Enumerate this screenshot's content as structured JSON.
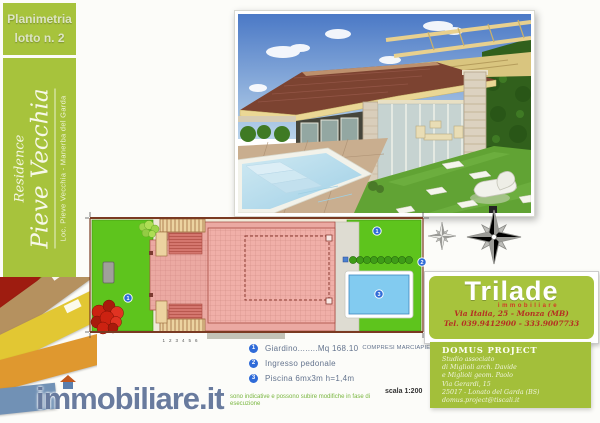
{
  "plan_label": {
    "line1": "Planimetria",
    "line2": "lotto n. 2"
  },
  "sidebar": {
    "prefix": "Residence",
    "name": "Pieve Vecchia",
    "location": "Loc. Pieve Vecchia - Manerba del Garda"
  },
  "plan": {
    "step_numbers": "123456",
    "markers": {
      "garden": "1",
      "entrance": "2",
      "pool": "3"
    }
  },
  "legend": {
    "items": [
      {
        "num": "1",
        "text": "Giardino........Mq 168.10",
        "note": "COMPRESI MARCIAPIEDI"
      },
      {
        "num": "2",
        "text": "Ingresso pedonale",
        "note": ""
      },
      {
        "num": "3",
        "text": "Piscina 6mx3m  h=1,4m",
        "note": ""
      }
    ]
  },
  "scale_label": "scala 1:200",
  "agency": {
    "name": "Trilade",
    "tagline": "immobiliare",
    "address": "Via Italia, 25 - Monza (MB)",
    "phone": "Tel. 039.9412900 - 333.9007733"
  },
  "studio": {
    "title": "DOMUS PROJECT",
    "line1": "Studio associato",
    "line2": "di Miglioli arch. Davide",
    "line3": "e Miglioli geom. Paolo",
    "line4": "Via Gerardi, 15",
    "line5": "25017 - Lonato del Garda (BS)",
    "line6": "domus.project@tiscali.it"
  },
  "watermark": {
    "text": "immobiliare.it",
    "disclaimer": "sono indicative e possono subire modifiche in fase di esecuzione"
  },
  "colors": {
    "accent_green": "#a7c33c",
    "garden_green": "#5ec41d",
    "pool_blue": "#82cbf0",
    "building_pink": "#eba9a2",
    "marker_blue": "#2f6bd8",
    "brand_red": "#c23a28"
  }
}
